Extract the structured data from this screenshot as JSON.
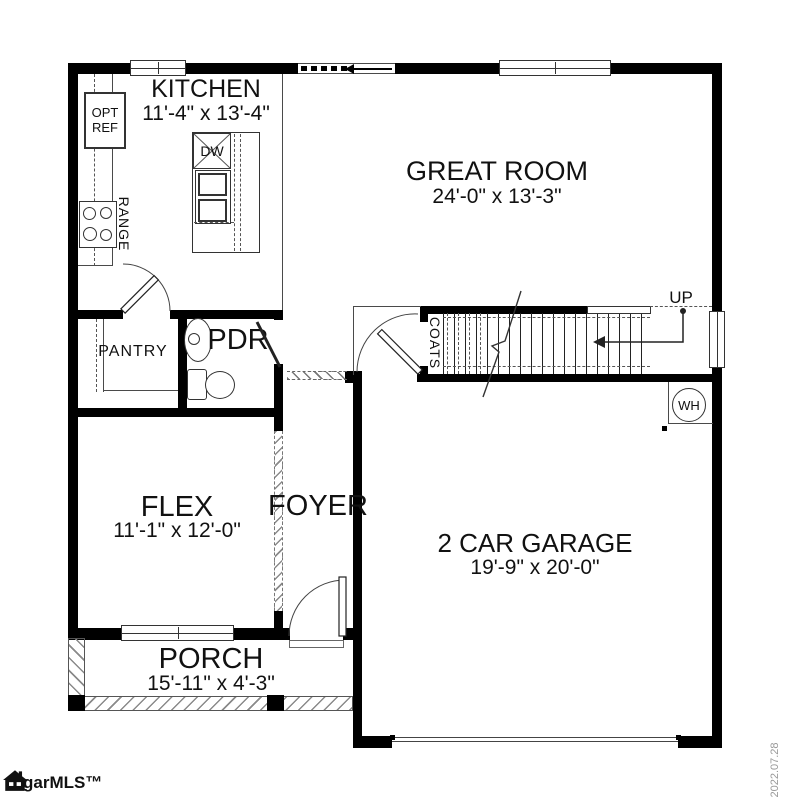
{
  "plan": {
    "rooms": [
      {
        "name": "KITCHEN",
        "dims": "11'-4\" x 13'-4\""
      },
      {
        "name": "GREAT ROOM",
        "dims": "24'-0\" x 13'-3\""
      },
      {
        "name": "PANTRY",
        "dims": ""
      },
      {
        "name": "PDR",
        "dims": ""
      },
      {
        "name": "FLEX",
        "dims": "11'-1\" x 12'-0\""
      },
      {
        "name": "FOYER",
        "dims": ""
      },
      {
        "name": "2 CAR GARAGE",
        "dims": "19'-9\" x 20'-0\""
      },
      {
        "name": "PORCH",
        "dims": "15'-11\" x 4'-3\""
      }
    ],
    "fixtures": {
      "coats": "COATS",
      "up": "UP",
      "water_heater": "WH",
      "dishwasher": "DW",
      "range": "RANGE",
      "opt_ref_line1": "OPT",
      "opt_ref_line2": "REF"
    },
    "footer": {
      "logo": "garMLS™",
      "date": "2022.07.28"
    },
    "colors": {
      "wall": "#000000",
      "line": "#444444",
      "date_text": "#999999"
    }
  }
}
